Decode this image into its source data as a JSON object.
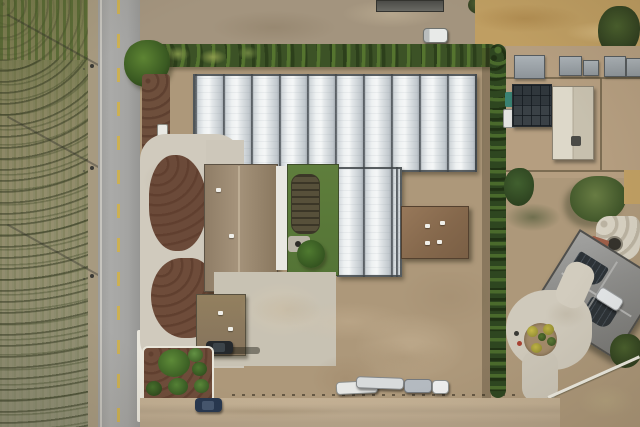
{
  "scene": {
    "type": "aerial-drone-photo",
    "aria_label": "Aerial view of a rural property with rows of greenhouses, a farmhouse, a two-lane road, crop fields and neighboring homestead",
    "visible_text": "none",
    "orientation": "top-down"
  },
  "palette": {
    "dirt": "#ad987a",
    "dirt_light": "#c6b295",
    "crop_field_green": "#6f7747",
    "crop_field_scrub": "#8f8f6e",
    "road_asphalt": "#a6a6a4",
    "road_dash_yellow": "#ccb054",
    "curb_white": "#e9e6dc",
    "hedge_green": "#3c5226",
    "greenhouse_panel": "#eef1f2",
    "greenhouse_frame": "#5a6065",
    "mulch_brown": "#6b4a39",
    "lawn_green": "#5f7e3c",
    "neighbor_lawn": "#6f8748",
    "main_roof_tan": "#9b8971",
    "guest_roof_brown": "#8d7a61",
    "workshop_roof_brown": "#8c6f52",
    "neighbor_roof_gray": "#8e8e8c",
    "solar_panel_dark": "#2d3338",
    "dry_field_gold": "#c09f63",
    "barn_white": "#ddd8c9"
  },
  "features": {
    "greenhouses": {
      "top_block_bays": 10,
      "right_strip_bays": 2,
      "material": "white poly panels"
    },
    "buildings": [
      {
        "name": "main-house",
        "roof": "tan-brown"
      },
      {
        "name": "guest-house",
        "roof": "brown, two roof vents"
      },
      {
        "name": "workshop",
        "roof": "brown, four roof vents"
      },
      {
        "name": "neighbor-house",
        "roof": "gray hip roof with solar panels, rotated"
      },
      {
        "name": "solar-barn",
        "roof": "dark gray with solar array"
      },
      {
        "name": "white-barn",
        "roof": "light gable roof"
      },
      {
        "name": "storage-sheds",
        "count": 5
      },
      {
        "name": "farm-building-top",
        "roof": "dark gray"
      }
    ],
    "vehicles": [
      {
        "name": "black-car",
        "location": "beside guest house"
      },
      {
        "name": "navy-car",
        "location": "south access road"
      },
      {
        "name": "white-box-truck",
        "location": "north gravel yard"
      },
      {
        "name": "white-car",
        "location": "beside neighbor house"
      },
      {
        "name": "trailers-row",
        "count": 4,
        "location": "south edge of dirt lot"
      }
    ],
    "landscape": [
      {
        "name": "crop-field",
        "pattern": "vertical planted rows with young plants"
      },
      {
        "name": "road",
        "lanes": 2,
        "marking": "dashed yellow center line"
      },
      {
        "name": "hedge-row-north",
        "type": "trees and shrubs"
      },
      {
        "name": "cypress-hedge-east",
        "type": "tall narrow hedge"
      },
      {
        "name": "mulch-islands",
        "count": 2
      },
      {
        "name": "shrub-bed",
        "bushes": 6
      },
      {
        "name": "circular-driveway-island",
        "small_trees": 5
      },
      {
        "name": "backyard",
        "items": [
          "lawn",
          "garden-plot",
          "round-tree",
          "patio"
        ]
      },
      {
        "name": "utility-poles",
        "count": 4,
        "power_lines": 3
      }
    ]
  }
}
